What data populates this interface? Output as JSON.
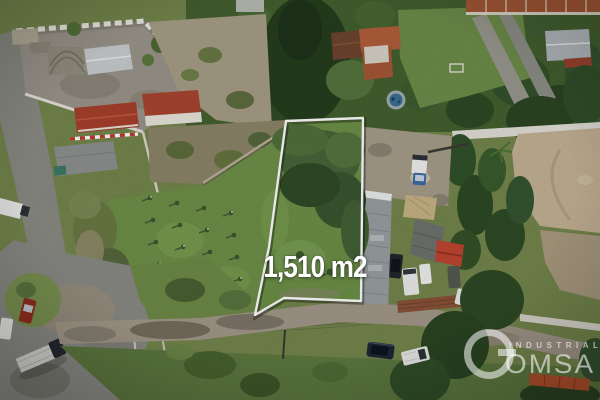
{
  "meta": {
    "type": "aerial-drone-photograph",
    "subject": "Real-estate aerial photo of a land plot for sale, outlined in white",
    "width_px": 600,
    "height_px": 400
  },
  "overlay": {
    "area_label": "1,510 m2",
    "boundary_color": "#ffffff"
  },
  "watermark": {
    "monogram_letter": "G",
    "tagline": "INDUSTRIAL",
    "brand_text": "OMSA",
    "color": "#ffffff"
  },
  "scene": {
    "palette": {
      "plot_grass": "#6d9148",
      "field_grass": "#6f9149",
      "scrub_green": "#47663a",
      "dark_trees": "#2e4a25",
      "dirt": "#a89e8b",
      "sand_lot": "#c4b396",
      "asphalt": "#8b8b86",
      "dirt_road": "#a3998a",
      "terracotta_roof": "#b25f3b",
      "red_roof": "#c14532",
      "metal_roof": "#b5bbbf",
      "white_wall": "#e8e6de",
      "pool_blue": "#3c7093"
    },
    "landmarks": [
      {
        "id": "outlined-plot",
        "label": "Vacant grass plot outlined in white, 1,510 m2"
      },
      {
        "id": "walled-compound",
        "label": "Walled dirt yard with white crenellated wall and metal-roof building (top left)"
      },
      {
        "id": "red-roof-buildings",
        "label": "Red tile roof buildings below the compound"
      },
      {
        "id": "tree-band",
        "label": "Dense trees and conifer above the plot"
      },
      {
        "id": "terracotta-houses",
        "label": "Houses with terracotta roofs and round pool (top middle-right)"
      },
      {
        "id": "lawn-paths",
        "label": "Green lawn with paved paths and soccer goal (top right)"
      },
      {
        "id": "warehouse",
        "label": "Long gray warehouse right of the plot with canopy, vans and red roof section"
      },
      {
        "id": "sand-lot",
        "label": "Open sandy lot (right)"
      },
      {
        "id": "sapling-field",
        "label": "Grass field with rows of planted saplings (left of plot)"
      },
      {
        "id": "parking-area",
        "label": "Asphalt lot with red pickup on grass island and flatbed truck (bottom left)"
      },
      {
        "id": "dirt-road",
        "label": "Dirt road across the bottom with utility poles and parked dark sedan"
      },
      {
        "id": "bottom-right-yard",
        "label": "Fenced yard with white vans, long white wall, trees and orange containers (bottom right)"
      }
    ]
  }
}
